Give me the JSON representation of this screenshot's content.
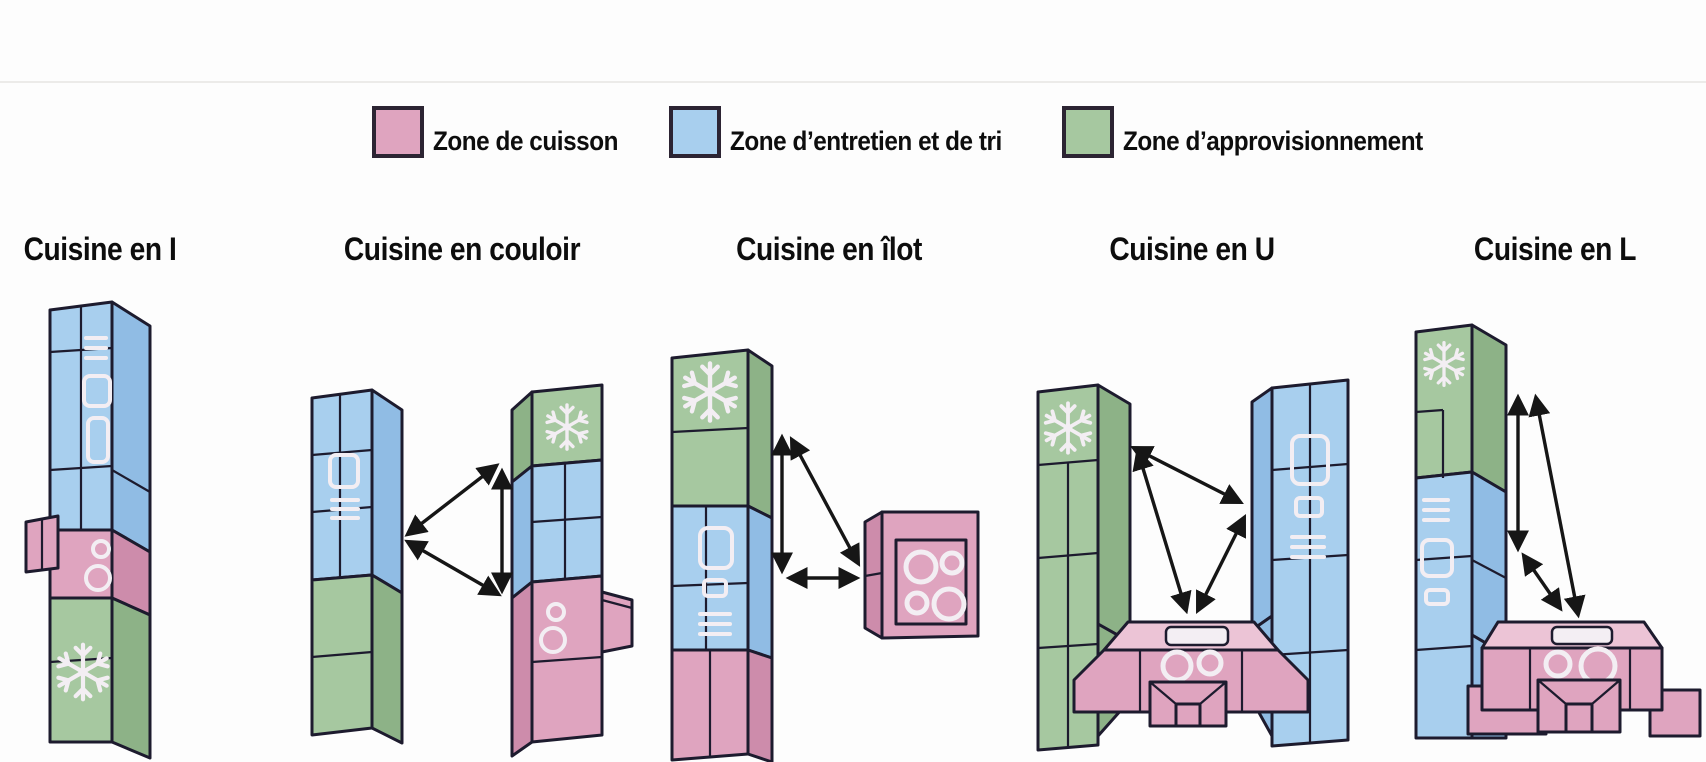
{
  "page": {
    "type": "infographic-diagram",
    "subject": "Implantations de cuisine (kitchen layout types) avec triangle d'activité"
  },
  "colors": {
    "bg": "#fdfdfd",
    "cook": "#dfa4bf",
    "cook-dark": "#cd8cab",
    "cook-light": "#ecc4d6",
    "clean": "#a8cfee",
    "clean-dark": "#90bce4",
    "stock": "#a6c8a0",
    "stock-dark": "#8db287",
    "outline": "#1d1b2e",
    "icon": "#f3eef3",
    "arrow": "#161616",
    "text": "#0d0d0d",
    "swatch-border": "#2c2433",
    "divider": "#ecebe9"
  },
  "legend": {
    "items": [
      {
        "label": "Zone de cuisson",
        "zone": "cuisson",
        "color": "#dfa4bf"
      },
      {
        "label": "Zone d’entretien et de tri",
        "zone": "entretien-et-tri",
        "color": "#a8cfee"
      },
      {
        "label": "Zone d’approvisionnement",
        "zone": "approvisionnement",
        "color": "#a6c8a0"
      }
    ]
  },
  "diagrams": [
    {
      "title": "Cuisine en I",
      "zones_top_to_bottom": [
        "entretien-et-tri",
        "cuisson",
        "approvisionnement"
      ],
      "icons": [
        "sink",
        "hob-rings",
        "snowflake"
      ],
      "arrow_count": 0
    },
    {
      "title": "Cuisine en couloir",
      "zones_top_to_bottom": [
        "entretien-et-tri + approvisionnement (gauche)",
        "approvisionnement + entretien-et-tri + cuisson (droite)"
      ],
      "icons": [
        "sink",
        "snowflake",
        "hob-rings"
      ],
      "arrow_count": 3
    },
    {
      "title": "Cuisine en îlot",
      "zones_top_to_bottom": [
        "approvisionnement",
        "entretien-et-tri",
        "cuisson",
        "îlot cuisson séparé"
      ],
      "icons": [
        "snowflake",
        "sink",
        "hob-rings"
      ],
      "arrow_count": 3
    },
    {
      "title": "Cuisine en U",
      "zones": [
        "approvisionnement (gauche)",
        "cuisson (fond)",
        "entretien-et-tri (droite)"
      ],
      "icons": [
        "snowflake",
        "hob-rings",
        "sink"
      ],
      "arrow_count": 3
    },
    {
      "title": "Cuisine en L",
      "zones": [
        "approvisionnement (haut)",
        "entretien-et-tri (colonne)",
        "cuisson (retour droit)"
      ],
      "icons": [
        "snowflake",
        "sink",
        "hob-rings"
      ],
      "arrow_count": 3
    }
  ]
}
